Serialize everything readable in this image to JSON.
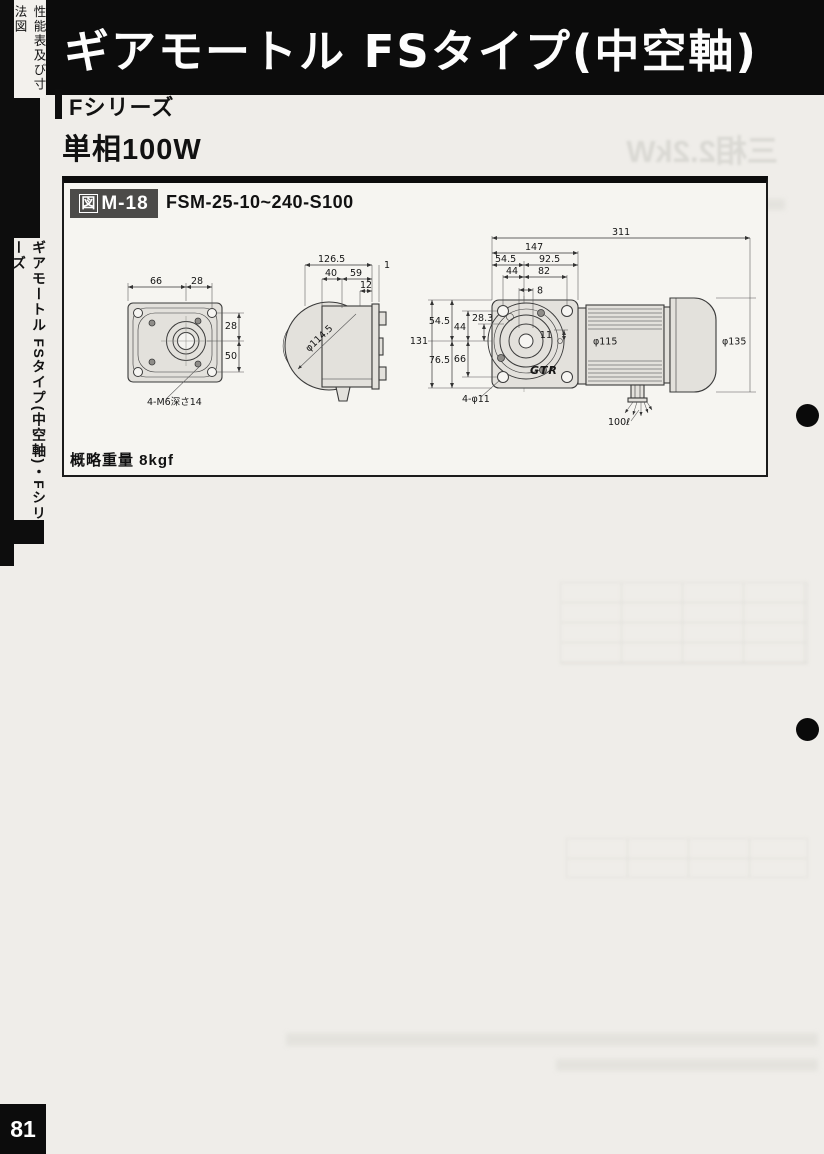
{
  "page": {
    "number": "81"
  },
  "edge_tabs": {
    "top_vertical_label": "性能表及び寸法図",
    "side_vertical_label": "ギアモートル FSタイプ(中空軸)・Fシリーズ"
  },
  "header": {
    "title": "ギアモートル FSタイプ(中空軸)"
  },
  "section": {
    "series": "Fシリーズ",
    "power": "単相100W"
  },
  "figure": {
    "tag_prefix": "図",
    "tag_code": "M-18",
    "model": "FSM-25-10~240-S100",
    "weight": "概略重量 8kgf",
    "brand_logo": "GTR"
  },
  "dims": {
    "fv_top_a": "66",
    "fv_top_b": "28",
    "fv_right_a": "28",
    "fv_right_b": "50",
    "fv_note": "4-M6深さ14",
    "sv_total": "126.5",
    "sv_gap": "1",
    "sv_a": "40",
    "sv_b": "59",
    "sv_c": "12",
    "sv_dia": "φ114.5",
    "av_total": "311",
    "av_gear": "147",
    "av_t1": "54.5",
    "av_t2": "92.5",
    "av_t3": "44",
    "av_t4": "82",
    "av_t5": "8",
    "av_l1": "54.5",
    "av_l2": "44",
    "av_l3": "28.3",
    "av_l4": "131",
    "av_l5": "76.5",
    "av_l6": "66",
    "av_center": "11",
    "av_motor_dia": "φ115",
    "av_fan_dia": "φ135",
    "av_holes": "4-φ11",
    "av_cable": "100ℓ"
  },
  "ghost": {
    "title": "三相2.2kW"
  }
}
